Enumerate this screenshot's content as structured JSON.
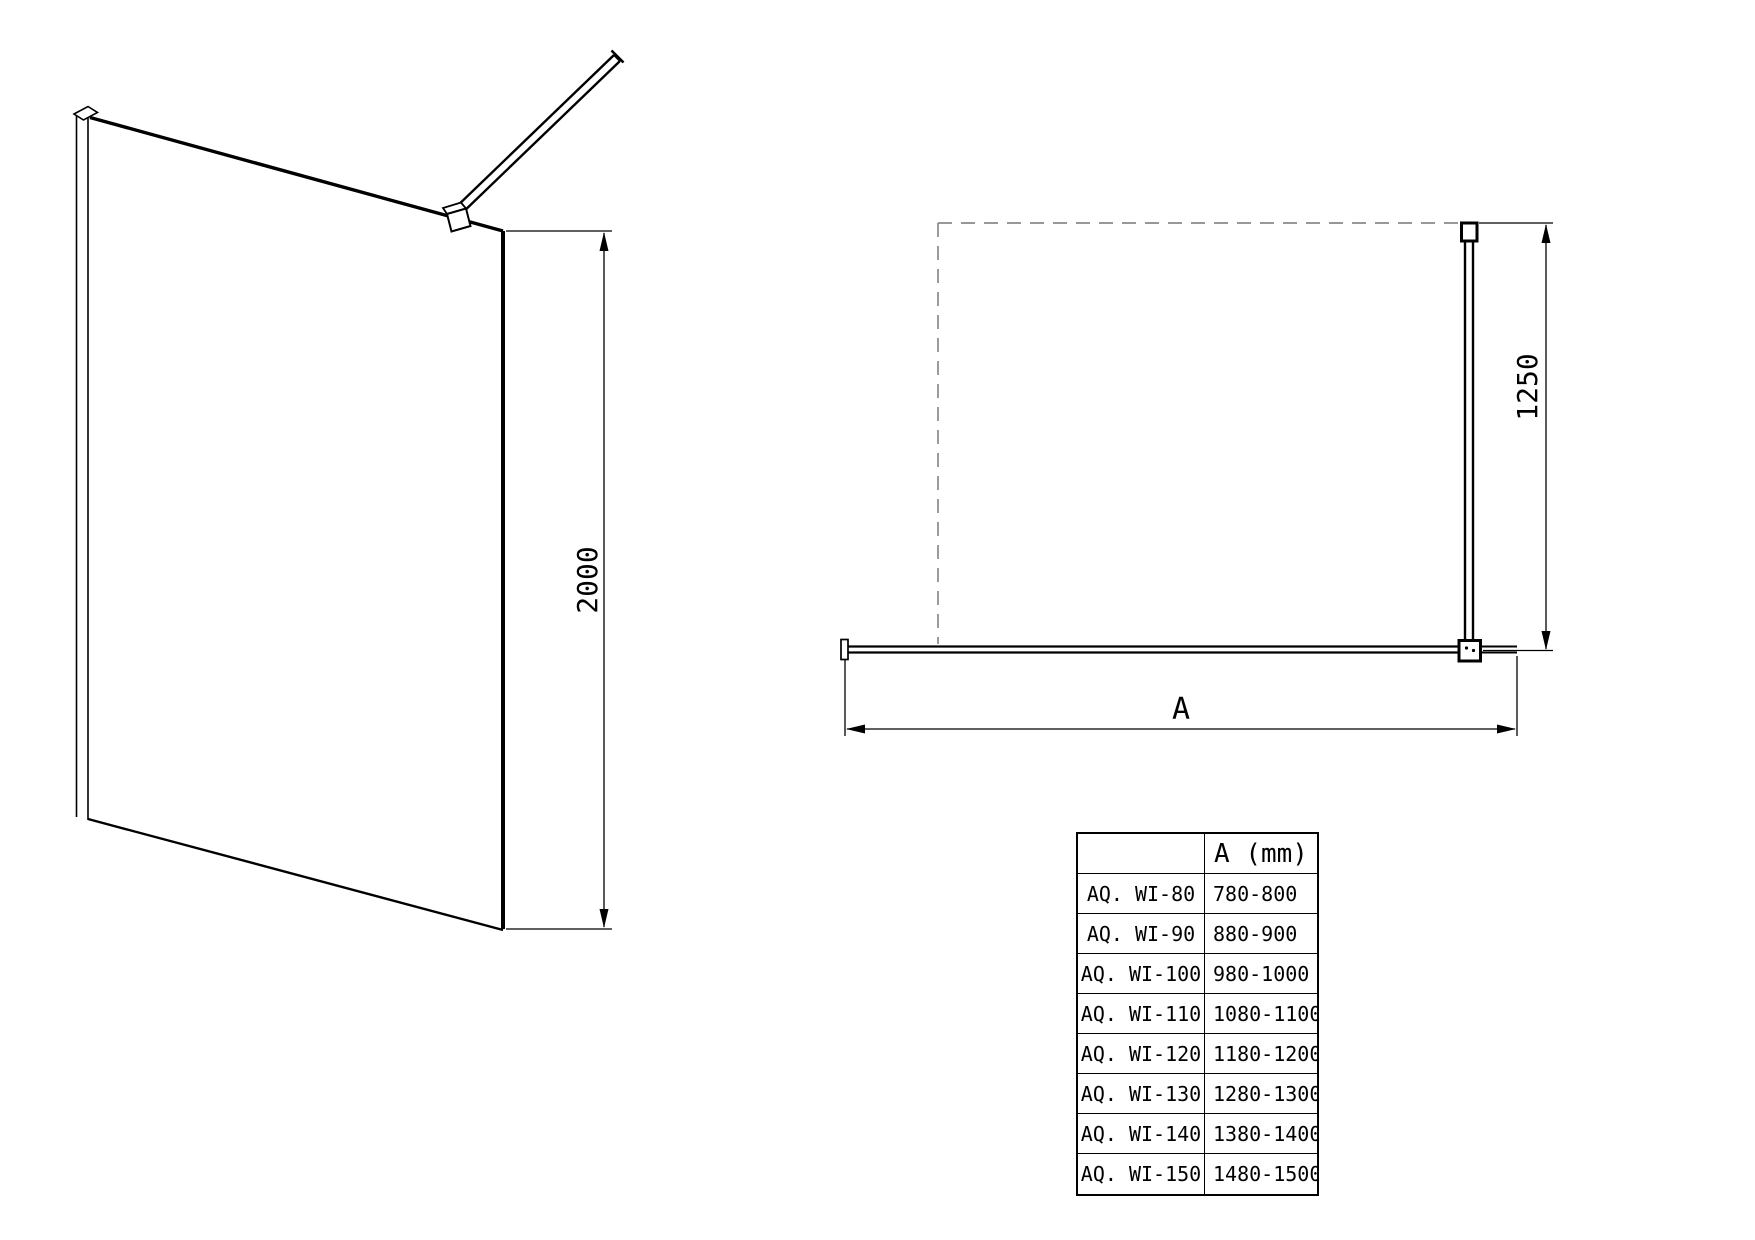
{
  "front_view": {
    "height_dim": "2000"
  },
  "top_view": {
    "bar_length_dim": "1250",
    "width_dim_label": "A"
  },
  "spec_table": {
    "col_headers": [
      "",
      "A (mm)"
    ],
    "rows": [
      {
        "model": "AQ. WI-80",
        "a_range": "780-800"
      },
      {
        "model": "AQ. WI-90",
        "a_range": "880-900"
      },
      {
        "model": "AQ. WI-100",
        "a_range": "980-1000"
      },
      {
        "model": "AQ. WI-110",
        "a_range": "1080-1100"
      },
      {
        "model": "AQ. WI-120",
        "a_range": "1180-1200"
      },
      {
        "model": "AQ. WI-130",
        "a_range": "1280-1300"
      },
      {
        "model": "AQ. WI-140",
        "a_range": "1380-1400"
      },
      {
        "model": "AQ. WI-150",
        "a_range": "1480-1500"
      }
    ]
  },
  "colors": {
    "line": "#000000",
    "dashed_wall": "#8a8a8a",
    "background": "#ffffff"
  }
}
